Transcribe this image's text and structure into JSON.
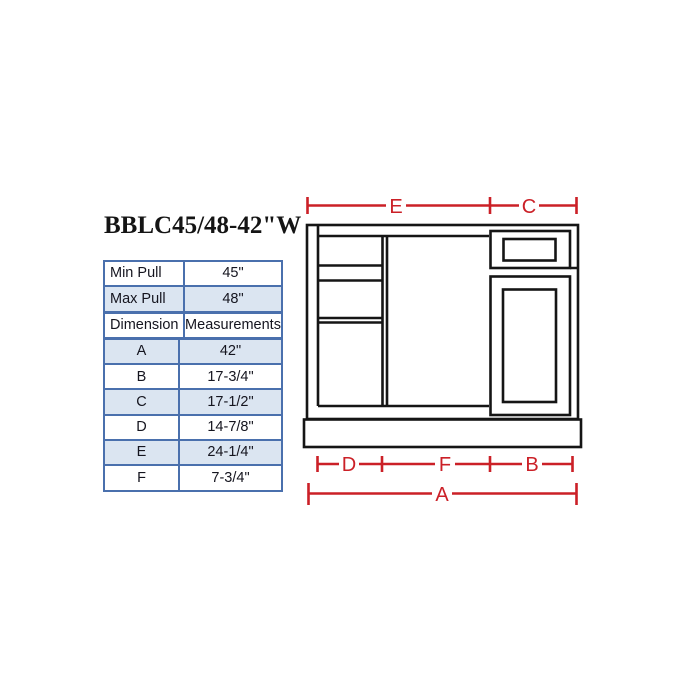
{
  "header": {
    "title": "BBLC45/48-42\"W"
  },
  "spec_table": {
    "rows": [
      {
        "dim": "Min Pull",
        "meas": "45\""
      },
      {
        "dim": "Max Pull",
        "meas": "48\""
      },
      {
        "dim": "Dimension",
        "meas": "Measurements"
      },
      {
        "dim": "A",
        "meas": "42\""
      },
      {
        "dim": "B",
        "meas": "17-3/4\""
      },
      {
        "dim": "C",
        "meas": "17-1/2\""
      },
      {
        "dim": "D",
        "meas": "14-7/8\""
      },
      {
        "dim": "E",
        "meas": "24-1/4\""
      },
      {
        "dim": "F",
        "meas": "7-3/4\""
      }
    ],
    "border_color": "#4a70ad",
    "alt_row_color": "#dbe5f1",
    "text_color": "#15151f"
  },
  "diagram": {
    "type": "cabinet-front-elevation",
    "dimension_color": "#cb2027",
    "line_color": "#151515",
    "labels": {
      "top_left": "E",
      "top_right": "C",
      "bottom_left": "D",
      "bottom_mid": "F",
      "bottom_right": "B",
      "overall": "A"
    }
  }
}
